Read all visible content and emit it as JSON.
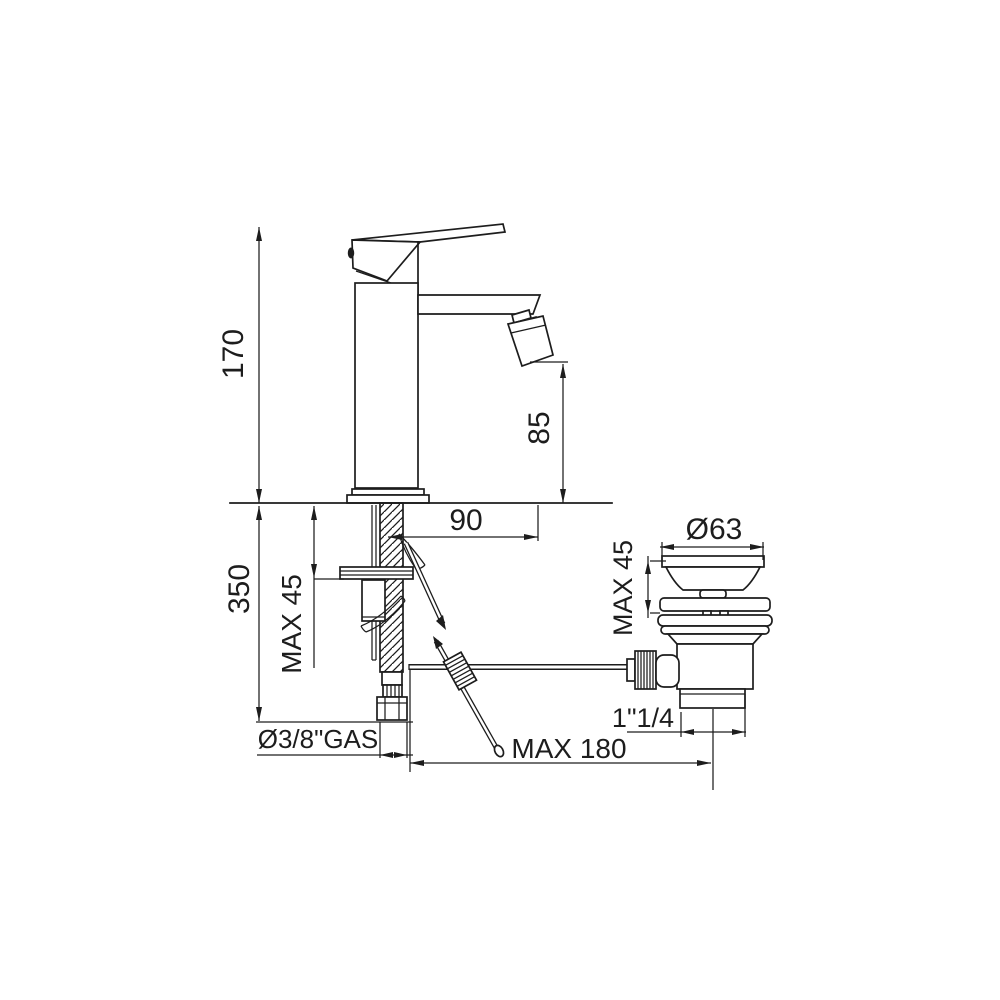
{
  "drawing": {
    "background": "#ffffff",
    "line_color": "#1d1d1d",
    "subject": "single-lever bidet mixer with pop-up waste, dimensioned installation drawing",
    "labels": {
      "total_height": "170",
      "spout_outlet_height": "85",
      "spout_reach": "90",
      "below_deck_height": "350",
      "deck_thickness_faucet": "MAX 45",
      "supply_connection": "Ø3/8\"GAS",
      "waste_flange_diameter": "Ø63",
      "deck_thickness_waste": "MAX 45",
      "waste_thread": "1\"1/4",
      "rod_horizontal_max": "MAX 180"
    }
  }
}
